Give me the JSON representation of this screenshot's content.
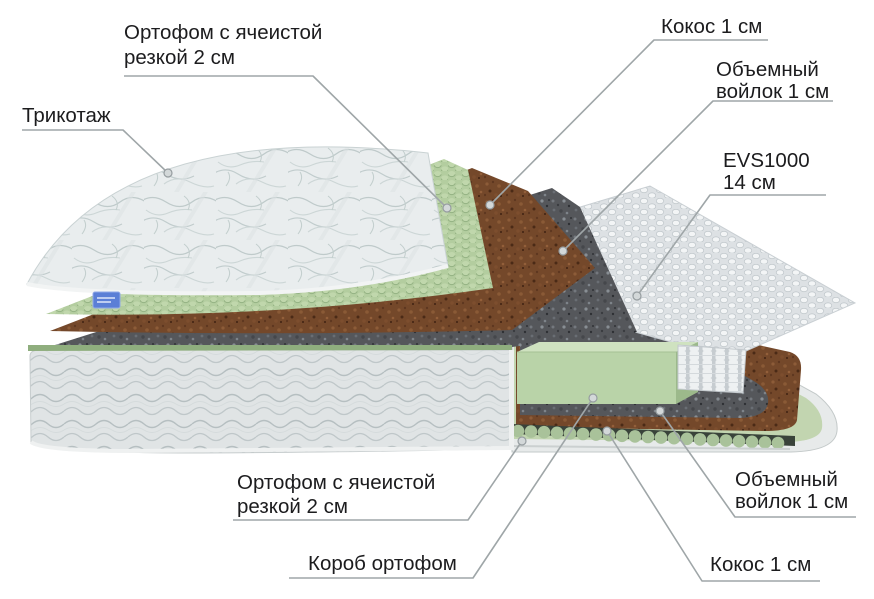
{
  "diagram": {
    "type": "mattress-layer-cutaway",
    "labels": {
      "orthofoam_top": {
        "line1": "Ортофом с ячеистой",
        "line2": "резкой 2 см"
      },
      "tricot": {
        "text": "Трикотаж"
      },
      "coco_top": {
        "text": "Кокос 1 см"
      },
      "felt_top": {
        "line1": "Объемный",
        "line2": "войлок 1 см"
      },
      "springs": {
        "line1": "EVS1000",
        "line2": "14 см"
      },
      "orthofoam_bottom": {
        "line1": "Ортофом с ячеистой",
        "line2": "резкой 2 см"
      },
      "box": {
        "text": "Короб ортофом"
      },
      "felt_bottom": {
        "line1": "Объемный",
        "line2": "войлок 1 см"
      },
      "coco_bottom": {
        "text": "Кокос 1 см"
      }
    },
    "colors": {
      "background": "#ffffff",
      "label_text": "#1c1c1e",
      "leader_line": "#9fa6a8",
      "foam_green": "#b6d0a2",
      "foam_green_block": "#b9d3a8",
      "coco_brown": "#74482a",
      "felt_gray": "#55575b",
      "spring_white": "#e7eaec",
      "fabric_light": "#e8ecee",
      "brand_tag_blue": "#5b7fd6"
    }
  }
}
